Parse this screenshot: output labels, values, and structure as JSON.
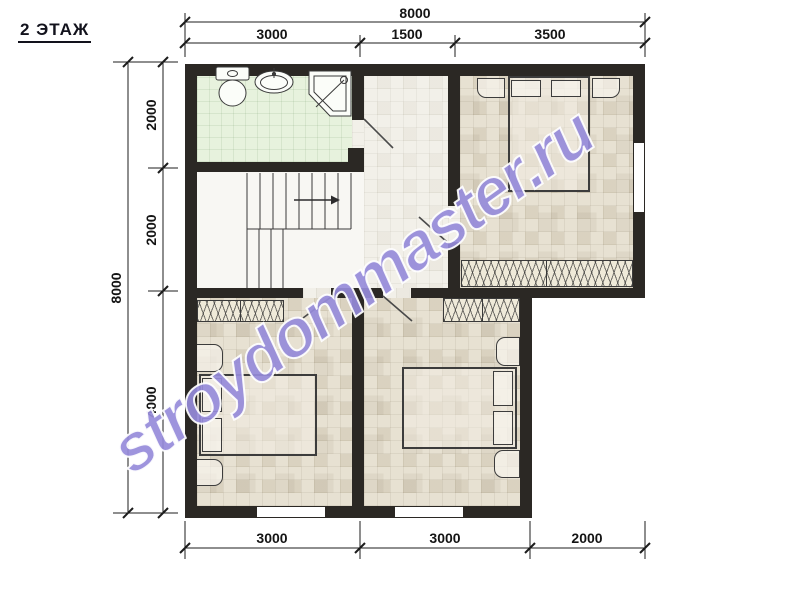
{
  "title": "2 ЭТАЖ",
  "watermark": "stroydommaster.ru",
  "dimensions": {
    "top": {
      "total": "8000",
      "segments": [
        "3000",
        "1500",
        "3500"
      ]
    },
    "left": {
      "total": "8000",
      "segments": [
        "2000",
        "2000",
        "4000"
      ]
    },
    "bottom": {
      "segments": [
        "3000",
        "3000",
        "2000"
      ]
    }
  },
  "colors": {
    "wall": "#2b2824",
    "bathroom_floor": "#e7f2dd",
    "bedroom_floor": "#e7e1d2",
    "hall_floor": "#f2f0e9",
    "watermark": "#5d4dc6",
    "dimension_text": "#141414"
  },
  "rooms": {
    "bathroom_fixtures": [
      "toilet-icon",
      "sink-icon",
      "shower-icon"
    ],
    "stairs_direction": "right"
  }
}
